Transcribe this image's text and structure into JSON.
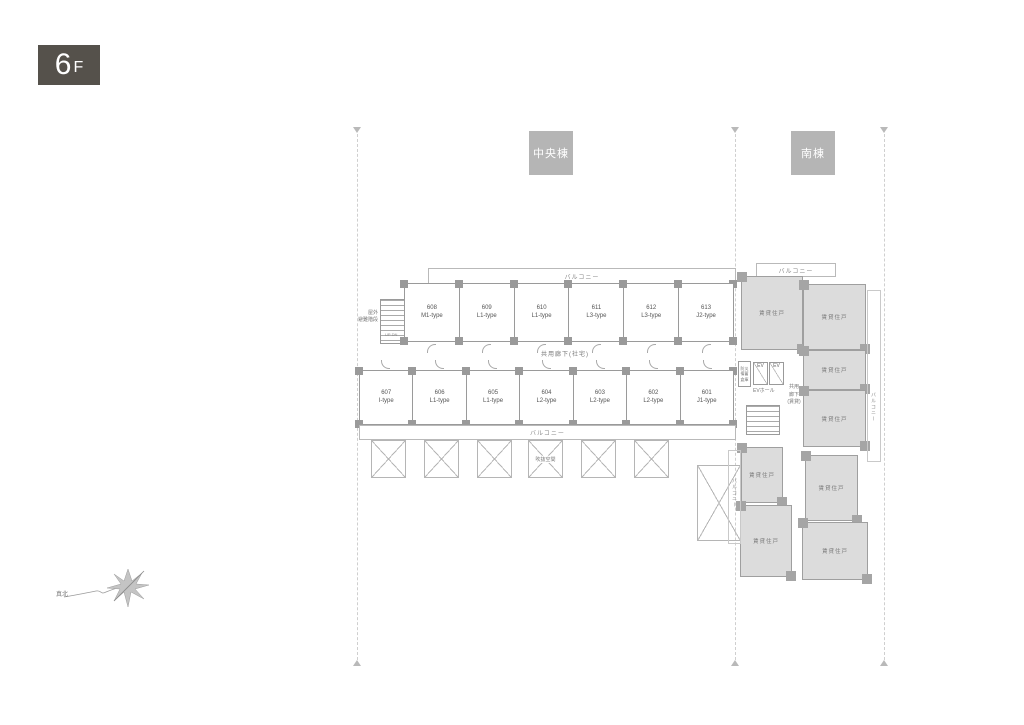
{
  "floor_badge": {
    "number": "6",
    "suffix": "F"
  },
  "section_labels": {
    "central": "中央棟",
    "south": "南棟"
  },
  "central": {
    "balcony_top": "バルコニー",
    "balcony_bottom": "バルコニー",
    "corridor": "共用廊下(社宅)",
    "stairs_label_1": "屋外",
    "stairs_label_2": "避難階段",
    "stairs_updn": "UP DN",
    "void_label": "吹抜空間",
    "top_row": [
      {
        "number": "608",
        "type": "M1-type"
      },
      {
        "number": "609",
        "type": "L1-type"
      },
      {
        "number": "610",
        "type": "L1-type"
      },
      {
        "number": "611",
        "type": "L3-type"
      },
      {
        "number": "612",
        "type": "L3-type"
      },
      {
        "number": "613",
        "type": "J2-type"
      }
    ],
    "bottom_row": [
      {
        "number": "607",
        "type": "I-type"
      },
      {
        "number": "606",
        "type": "L1-type"
      },
      {
        "number": "605",
        "type": "L1-type"
      },
      {
        "number": "604",
        "type": "L2-type"
      },
      {
        "number": "603",
        "type": "L2-type"
      },
      {
        "number": "602",
        "type": "L2-type"
      },
      {
        "number": "601",
        "type": "J1-type"
      }
    ]
  },
  "core": {
    "ev": "EV",
    "ev_hall": "EVホール",
    "corridor_1": "共用",
    "corridor_2": "廊下",
    "corridor_3": "(賃貸)",
    "storage_1": "防災",
    "storage_2": "備蓄",
    "storage_3": "倉庫"
  },
  "south": {
    "unit": "賃貸住戸",
    "balcony_top": "バルコニー",
    "balcony_right": "バルコニー",
    "balcony_left": "バルコニー"
  },
  "compass": {
    "label": "真北"
  },
  "colors": {
    "badge_bg": "#55514b",
    "section_bg": "#b5b5b5",
    "south_unit_fill": "#dcdcdc",
    "wall": "#9a9a9a"
  }
}
